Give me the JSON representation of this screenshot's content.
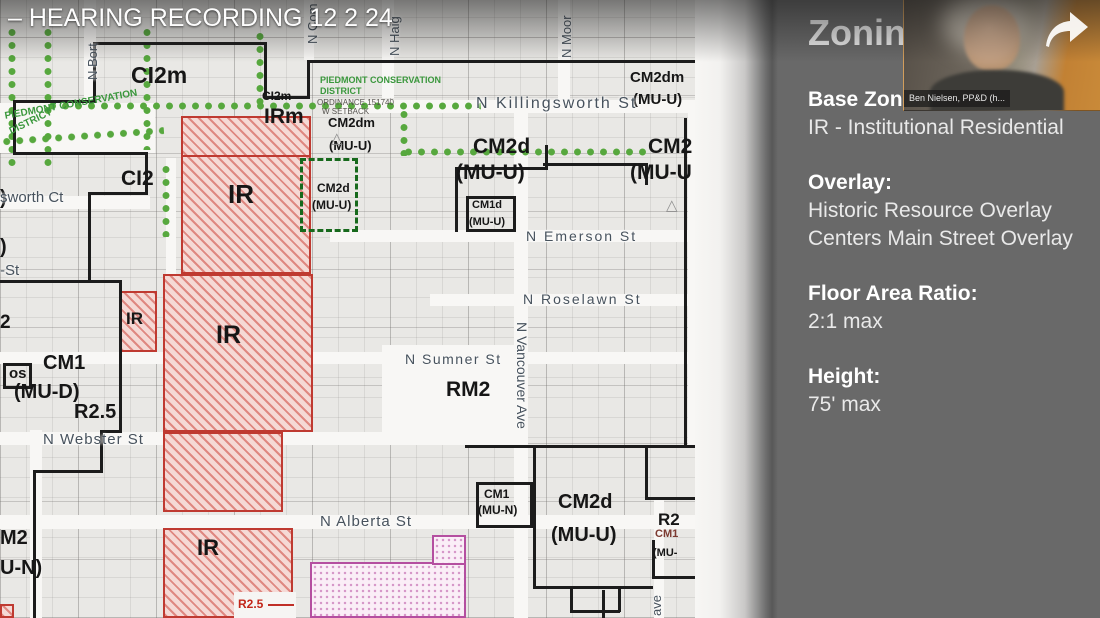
{
  "video": {
    "title_overlay": "– HEARING RECORDING 12 2 24"
  },
  "webcam": {
    "caption": "Ben Nielsen, PP&D (h..."
  },
  "panel": {
    "title": "Zoning",
    "bg_color": "#696969",
    "sections": [
      {
        "heading": "Base Zone:",
        "lines": [
          "IR - Institutional Residential"
        ]
      },
      {
        "heading": "Overlay:",
        "lines": [
          "Historic Resource Overlay",
          "Centers Main Street Overlay"
        ]
      },
      {
        "heading": "Floor Area Ratio:",
        "lines": [
          "2:1 max"
        ]
      },
      {
        "heading": "Height:",
        "lines": [
          "75' max"
        ]
      }
    ]
  },
  "map": {
    "colors": {
      "ir_zone": "#bf3a31",
      "overlay_dots": "#57a83e",
      "historic_magenta": "#b44fa0",
      "boundary": "#1c1c1c"
    },
    "triangle_glyph": "△",
    "streets_h": [
      [
        336,
        100,
        359,
        13
      ],
      [
        0,
        196,
        150,
        13
      ],
      [
        330,
        230,
        358,
        12
      ],
      [
        430,
        294,
        258,
        12
      ],
      [
        0,
        352,
        688,
        12
      ],
      [
        0,
        432,
        516,
        13
      ],
      [
        0,
        515,
        695,
        14
      ]
    ],
    "streets_v": [
      [
        84,
        0,
        12,
        100
      ],
      [
        382,
        0,
        12,
        98
      ],
      [
        304,
        0,
        10,
        60
      ],
      [
        514,
        112,
        14,
        506
      ],
      [
        558,
        0,
        12,
        100
      ],
      [
        688,
        112,
        10,
        336
      ],
      [
        166,
        158,
        10,
        116
      ],
      [
        30,
        430,
        12,
        188
      ],
      [
        654,
        500,
        10,
        118
      ]
    ],
    "open_areas": [
      [
        0,
        103,
        155,
        50
      ],
      [
        382,
        345,
        133,
        100
      ]
    ],
    "zones": [
      {
        "c": "zir",
        "r": [
          181,
          116,
          130,
          158
        ]
      },
      {
        "c": "zir",
        "r": [
          163,
          274,
          150,
          158
        ]
      },
      {
        "c": "zir",
        "r": [
          163,
          432,
          120,
          80
        ]
      },
      {
        "c": "zir",
        "r": [
          163,
          528,
          130,
          90
        ]
      },
      {
        "c": "zir",
        "r": [
          119,
          291,
          38,
          61
        ]
      },
      {
        "c": "zir",
        "r": [
          0,
          604,
          14,
          14
        ]
      },
      {
        "c": "zmag",
        "r": [
          310,
          562,
          156,
          56
        ]
      },
      {
        "c": "zmag",
        "r": [
          432,
          535,
          34,
          30
        ]
      },
      {
        "c": "notch",
        "r": [
          234,
          592,
          62,
          26
        ]
      }
    ],
    "green_dashed_box": [
      300,
      158,
      58,
      74
    ],
    "green_dots": [
      {
        "d": "v",
        "x": 8,
        "y": 26,
        "l": 140
      },
      {
        "d": "v",
        "x": 44,
        "y": 26,
        "l": 142
      },
      {
        "d": "v",
        "x": 143,
        "y": 26,
        "l": 124
      },
      {
        "d": "v",
        "x": 256,
        "y": 30,
        "l": 78
      },
      {
        "d": "h",
        "x": 46,
        "y": 102,
        "l": 435
      },
      {
        "d": "v",
        "x": 400,
        "y": 108,
        "l": 48
      },
      {
        "d": "h",
        "x": 402,
        "y": 148,
        "l": 246
      },
      {
        "d": "h",
        "x": 0,
        "y": 138,
        "l": 164,
        "rot": -4
      },
      {
        "d": "v",
        "x": 162,
        "y": 163,
        "l": 74
      }
    ],
    "boundaries": [
      [
        93,
        42,
        174,
        3
      ],
      [
        264,
        42,
        3,
        57
      ],
      [
        264,
        96,
        46,
        3
      ],
      [
        307,
        60,
        3,
        39
      ],
      [
        307,
        60,
        388,
        3
      ],
      [
        93,
        42,
        3,
        61
      ],
      [
        13,
        100,
        83,
        3
      ],
      [
        13,
        100,
        3,
        55
      ],
      [
        13,
        152,
        135,
        3
      ],
      [
        145,
        152,
        3,
        43
      ],
      [
        88,
        192,
        60,
        3
      ],
      [
        88,
        192,
        3,
        91
      ],
      [
        0,
        280,
        122,
        3
      ],
      [
        119,
        280,
        3,
        153
      ],
      [
        100,
        430,
        22,
        3
      ],
      [
        100,
        430,
        3,
        43
      ],
      [
        33,
        470,
        70,
        3
      ],
      [
        33,
        470,
        3,
        148
      ],
      [
        455,
        167,
        93,
        3
      ],
      [
        455,
        167,
        3,
        65
      ],
      [
        545,
        145,
        3,
        25
      ],
      [
        543,
        163,
        105,
        3
      ],
      [
        645,
        163,
        3,
        22
      ],
      [
        684,
        118,
        3,
        330
      ],
      [
        465,
        445,
        230,
        3
      ],
      [
        533,
        447,
        3,
        141
      ],
      [
        533,
        586,
        120,
        3
      ],
      [
        570,
        586,
        3,
        26
      ],
      [
        618,
        586,
        3,
        26
      ],
      [
        570,
        610,
        50,
        3
      ],
      [
        645,
        445,
        3,
        55
      ],
      [
        645,
        497,
        50,
        3
      ],
      [
        652,
        540,
        3,
        38
      ],
      [
        652,
        576,
        43,
        3
      ],
      [
        602,
        590,
        3,
        28
      ],
      {
        "box": [
          466,
          196,
          50,
          36
        ]
      },
      {
        "box": [
          3,
          363,
          29,
          26
        ]
      },
      {
        "box": [
          476,
          482,
          57,
          46
        ]
      },
      {
        "r": [
          181,
          155,
          130,
          2
        ],
        "c": "#bf3a31"
      },
      {
        "r": [
          268,
          604,
          26,
          2
        ],
        "c": "#c03028"
      }
    ],
    "zone_labels": [
      {
        "t": "CI2m",
        "x": 131,
        "y": 64,
        "s": 23
      },
      {
        "t": "CI2m",
        "x": 262,
        "y": 90,
        "s": 12
      },
      {
        "t": "IRm",
        "x": 264,
        "y": 106,
        "s": 21
      },
      {
        "t": "IR",
        "x": 228,
        "y": 181,
        "s": 26
      },
      {
        "t": "CI2",
        "x": 121,
        "y": 168,
        "s": 21
      },
      {
        "t": "CM2dm",
        "x": 328,
        "y": 116,
        "s": 13
      },
      {
        "t": "(MU-U)",
        "x": 329,
        "y": 139,
        "s": 13
      },
      {
        "t": "CM2dm",
        "x": 630,
        "y": 70,
        "s": 15
      },
      {
        "t": "(MU-U)",
        "x": 633,
        "y": 92,
        "s": 15
      },
      {
        "t": "CM2d",
        "x": 473,
        "y": 136,
        "s": 21
      },
      {
        "t": "(MU-U)",
        "x": 456,
        "y": 162,
        "s": 21
      },
      {
        "t": "CM2",
        "x": 648,
        "y": 136,
        "s": 21
      },
      {
        "t": "(MU-U",
        "x": 630,
        "y": 162,
        "s": 21
      },
      {
        "t": "CM2d",
        "x": 317,
        "y": 182,
        "s": 12
      },
      {
        "t": "(MU-U)",
        "x": 312,
        "y": 199,
        "s": 12
      },
      {
        "t": "CM1d",
        "x": 472,
        "y": 200,
        "s": 11
      },
      {
        "t": "(MU-U)",
        "x": 469,
        "y": 217,
        "s": 11
      },
      {
        "t": ")",
        "x": 0,
        "y": 188,
        "s": 20
      },
      {
        "t": ")",
        "x": 0,
        "y": 237,
        "s": 20
      },
      {
        "t": "2",
        "x": 0,
        "y": 313,
        "s": 19
      },
      {
        "t": "os",
        "x": 9,
        "y": 366,
        "s": 15
      },
      {
        "t": "CM1",
        "x": 43,
        "y": 353,
        "s": 20
      },
      {
        "t": "(MU-D)",
        "x": 14,
        "y": 382,
        "s": 20
      },
      {
        "t": "R2.5",
        "x": 74,
        "y": 402,
        "s": 20
      },
      {
        "t": "IR",
        "x": 126,
        "y": 310,
        "s": 17
      },
      {
        "t": "IR",
        "x": 216,
        "y": 323,
        "s": 25
      },
      {
        "t": "RM2",
        "x": 446,
        "y": 379,
        "s": 21
      },
      {
        "t": "M2",
        "x": 0,
        "y": 528,
        "s": 20
      },
      {
        "t": "U-N)",
        "x": 0,
        "y": 558,
        "s": 20
      },
      {
        "t": "CM1",
        "x": 484,
        "y": 488,
        "s": 12
      },
      {
        "t": "(MU-N)",
        "x": 478,
        "y": 504,
        "s": 12
      },
      {
        "t": "CM2d",
        "x": 558,
        "y": 492,
        "s": 20
      },
      {
        "t": "(MU-U)",
        "x": 551,
        "y": 525,
        "s": 20
      },
      {
        "t": "R2",
        "x": 658,
        "y": 511,
        "s": 17
      },
      {
        "t": "CM1",
        "x": 655,
        "y": 529,
        "s": 11,
        "c": "#7c3a31"
      },
      {
        "t": "(MU-",
        "x": 653,
        "y": 548,
        "s": 11
      },
      {
        "t": "IR",
        "x": 197,
        "y": 537,
        "s": 22
      },
      {
        "t": "R2.5",
        "x": 238,
        "y": 598,
        "s": 12,
        "c": "#c22619"
      }
    ],
    "street_labels": [
      {
        "t": "N Killingsworth St",
        "x": 476,
        "y": 96,
        "s": 16,
        "ls": 2
      },
      {
        "t": "sworth Ct",
        "x": 0,
        "y": 190,
        "s": 15
      },
      {
        "t": "-St",
        "x": 0,
        "y": 263,
        "s": 15
      },
      {
        "t": "N Webster St",
        "x": 43,
        "y": 432,
        "s": 15,
        "ls": 1
      },
      {
        "t": "N Emerson St",
        "x": 526,
        "y": 229,
        "s": 14,
        "ls": 2
      },
      {
        "t": "N Roselawn St",
        "x": 523,
        "y": 292,
        "s": 14,
        "ls": 2
      },
      {
        "t": "N Sumner St",
        "x": 405,
        "y": 352,
        "s": 14,
        "ls": 1.5
      },
      {
        "t": "N Alberta St",
        "x": 320,
        "y": 514,
        "s": 15,
        "ls": 1
      },
      {
        "t": "N Vancouver Ave",
        "x": 529,
        "y": 322,
        "s": 14,
        "dir": "vdn"
      },
      {
        "t": "N Bort",
        "x": 86,
        "y": 80,
        "s": 13,
        "dir": "vup"
      },
      {
        "t": "N Haig",
        "x": 388,
        "y": 56,
        "s": 13,
        "dir": "vup"
      },
      {
        "t": "N Moor",
        "x": 560,
        "y": 58,
        "s": 13,
        "dir": "vup"
      },
      {
        "t": "N Com",
        "x": 306,
        "y": 44,
        "s": 13,
        "dir": "vup"
      },
      {
        "t": "ave",
        "x": 650,
        "y": 616,
        "s": 13,
        "dir": "vup"
      }
    ],
    "green_texts": [
      {
        "t": "PIEDMONT CONSERVATION",
        "x": 4,
        "y": 112,
        "s": 10,
        "rot": -10
      },
      {
        "t": "DISTRICT",
        "x": 8,
        "y": 128,
        "s": 10,
        "rot": -26
      },
      {
        "t": "PIEDMONT CONSERVATION",
        "x": 320,
        "y": 76,
        "s": 9,
        "rot": 0
      },
      {
        "t": "DISTRICT",
        "x": 320,
        "y": 87,
        "s": 9,
        "rot": 0
      }
    ],
    "tiny_texts": [
      {
        "t": "ORDINANCE 151740",
        "x": 317,
        "y": 99,
        "s": 8
      },
      {
        "t": "W SETBACK",
        "x": 322,
        "y": 108,
        "s": 8
      }
    ],
    "triangles": [
      {
        "x": 331,
        "y": 131
      },
      {
        "x": 666,
        "y": 198
      }
    ]
  }
}
